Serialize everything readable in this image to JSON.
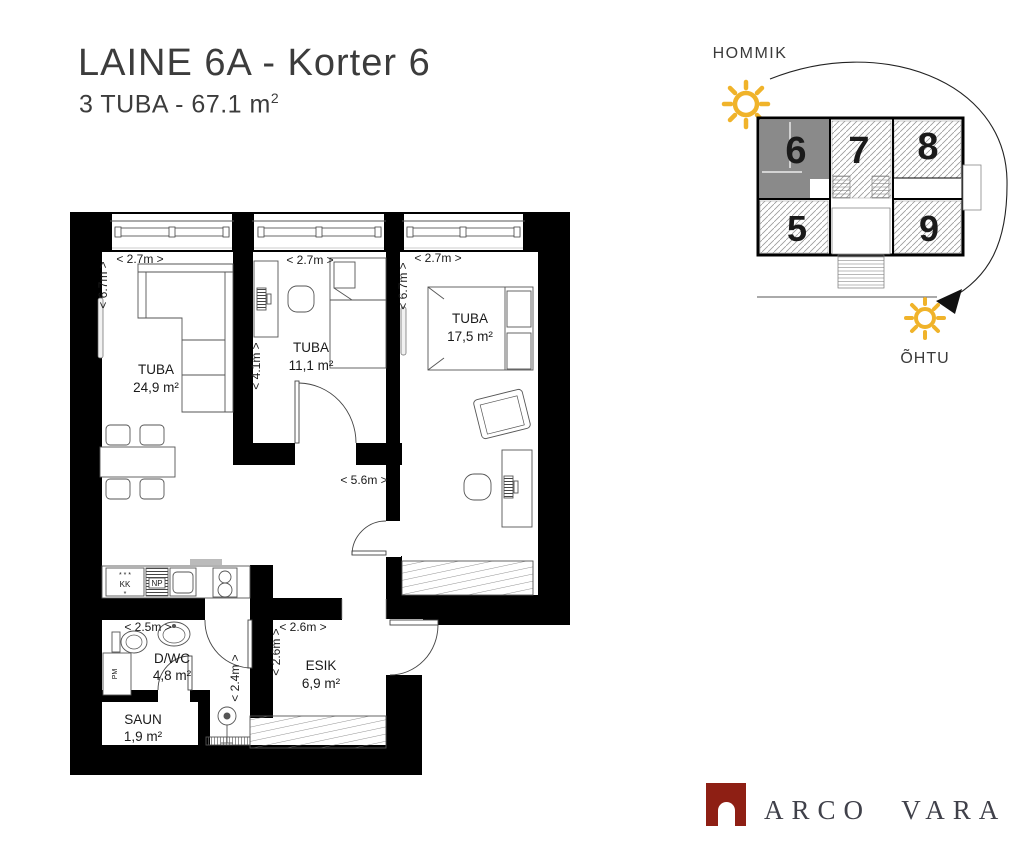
{
  "header": {
    "title": "LAINE 6A - Korter 6",
    "subtitle": "3 TUBA - 67.1 m",
    "subtitle_sup": "2"
  },
  "floorplan": {
    "rooms": {
      "living": {
        "name": "TUBA",
        "area": "24,9 m²"
      },
      "bedroom_small": {
        "name": "TUBA",
        "area": "11,1 m²"
      },
      "bedroom_large": {
        "name": "TUBA",
        "area": "17,5 m²"
      },
      "bathroom": {
        "name": "D/WC",
        "area": "4,8 m²"
      },
      "sauna": {
        "name": "SAUN",
        "area": "1,9 m²"
      },
      "hallway": {
        "name": "ESIK",
        "area": "6,9 m²"
      }
    },
    "dimensions": {
      "living_width": "< 2.7m >",
      "living_height": "< 6.7m >",
      "bedroom_small_width": "< 2.7m >",
      "bedroom_small_height": "< 4.1m >",
      "bedroom_large_width": "< 2.7m >",
      "bedroom_large_height": "< 6.7m >",
      "living_area_width": "< 5.6m >",
      "bathroom_width": "< 2.5m >",
      "bathroom_height": "< 2.4m >",
      "hallway_width": "< 2.6m >",
      "hallway_height": "< 2.6m >"
    },
    "appliances": {
      "fridge_stars": "* * *",
      "fridge": "KK",
      "fridge_star": "*",
      "dishwasher": "NP",
      "washing_machine": "PM"
    }
  },
  "minimap": {
    "morning": "HOMMIK",
    "evening": "ÕHTU",
    "units": [
      {
        "label": "5"
      },
      {
        "label": "6"
      },
      {
        "label": "7"
      },
      {
        "label": "8"
      },
      {
        "label": "9"
      }
    ],
    "highlighted_unit": "6"
  },
  "logo": {
    "text": "ARCO VARA"
  },
  "colors": {
    "sun": "#F0B32A",
    "unit_highlight": "#8A8A8A",
    "logo_red": "#8E1F14",
    "walls": "#000000"
  }
}
